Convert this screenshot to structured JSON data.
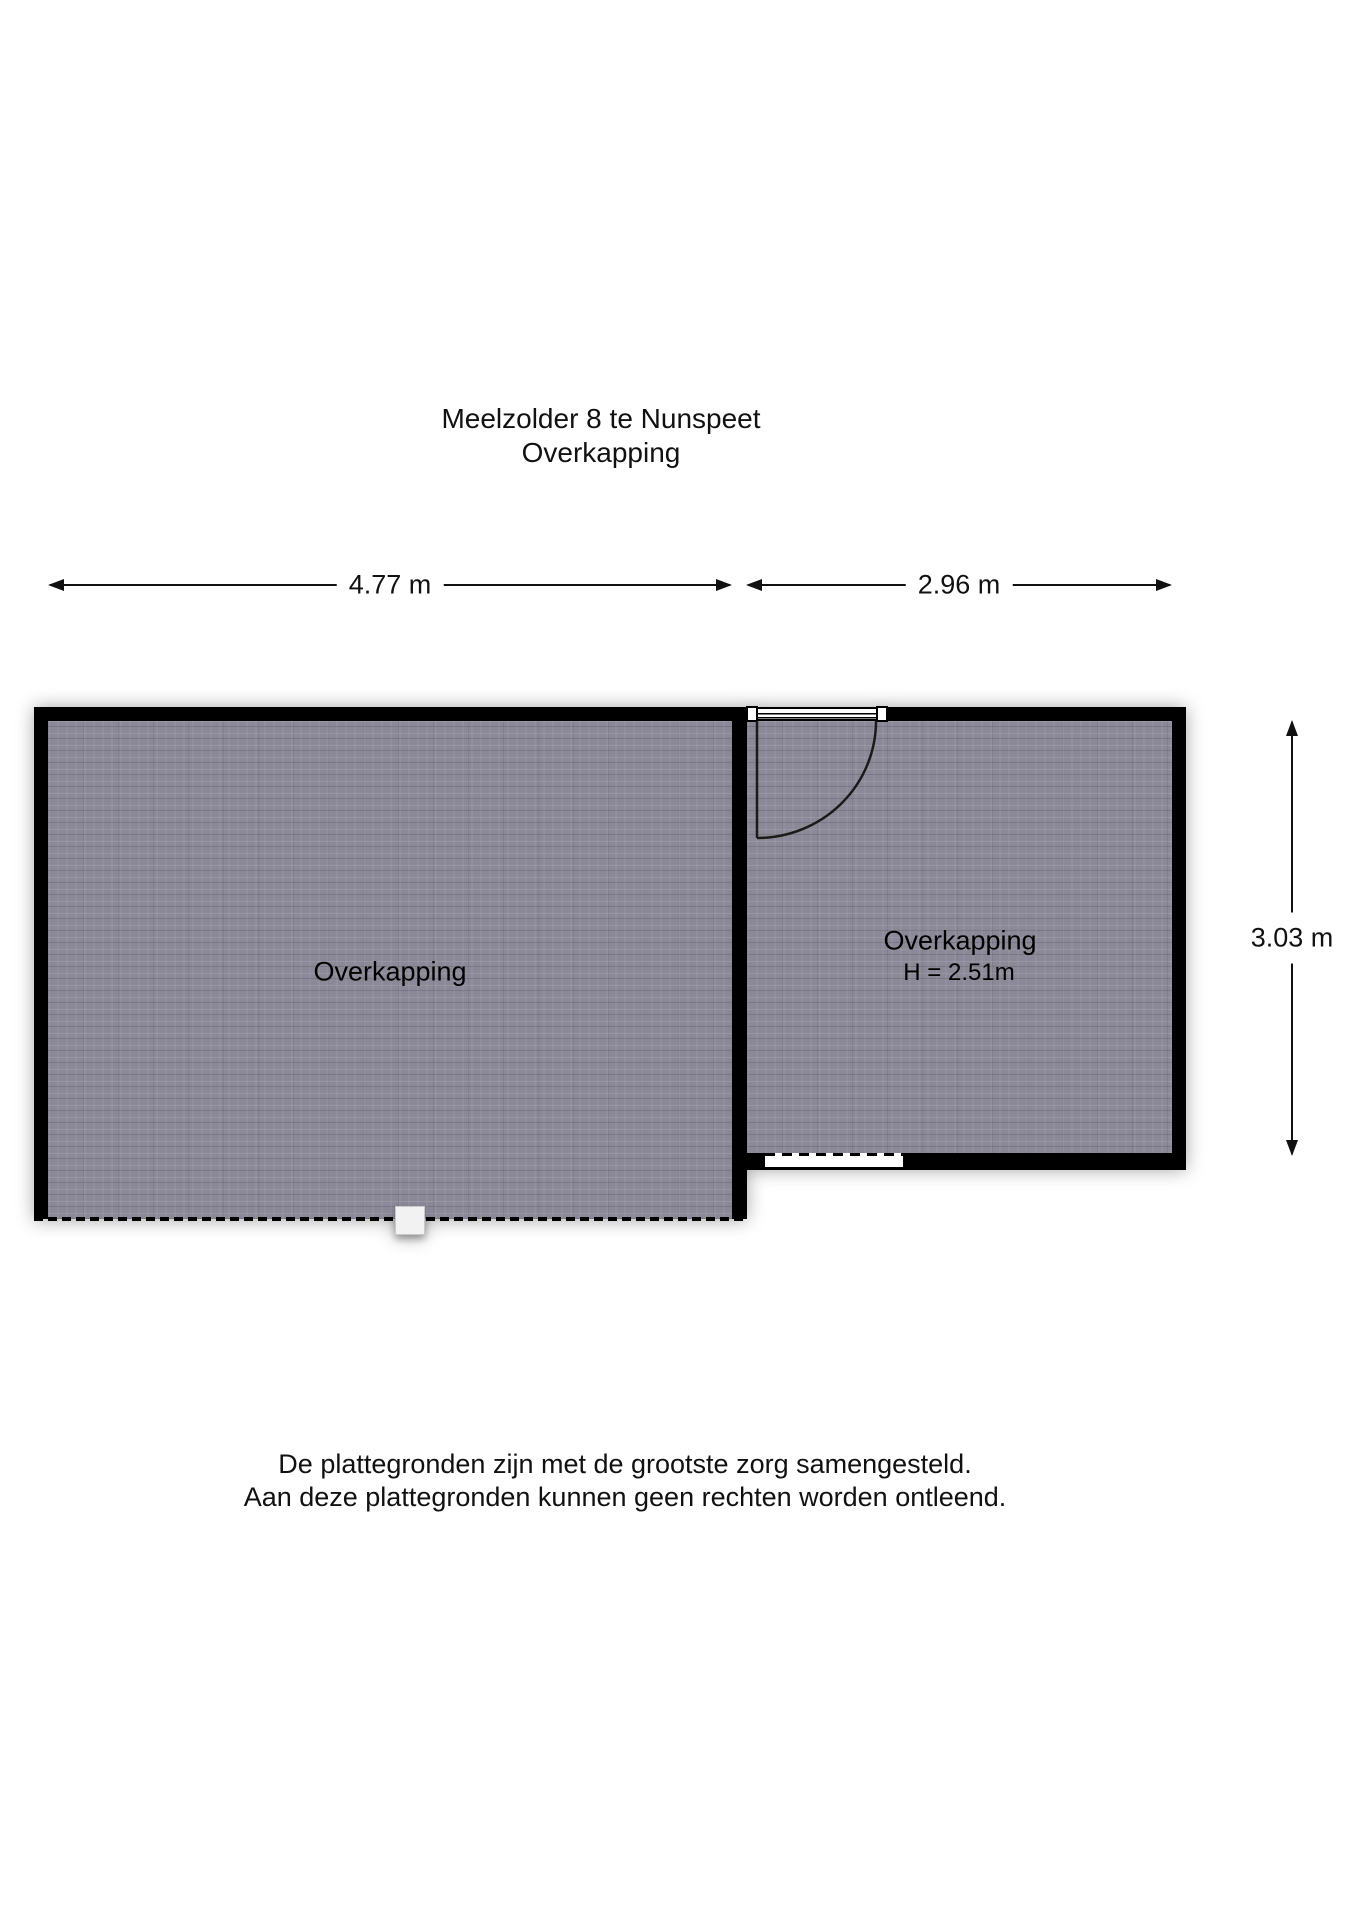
{
  "title": {
    "line1": "Meelzolder 8 te Nunspeet",
    "line2": "Overkapping"
  },
  "dimensions": {
    "left_width": "4.77 m",
    "right_width": "2.96 m",
    "right_height": "3.03 m"
  },
  "rooms": {
    "left": {
      "label": "Overkapping"
    },
    "right": {
      "label": "Overkapping",
      "height_note": "H = 2.51m"
    }
  },
  "disclaimer": {
    "line1": "De plattegronden zijn met de grootste zorg samengesteld.",
    "line2": "Aan deze plattegronden kunnen geen rechten worden ontleend."
  },
  "colors": {
    "wall": "#000000",
    "floor": "#8b8997",
    "background": "#ffffff",
    "text": "#111111"
  }
}
